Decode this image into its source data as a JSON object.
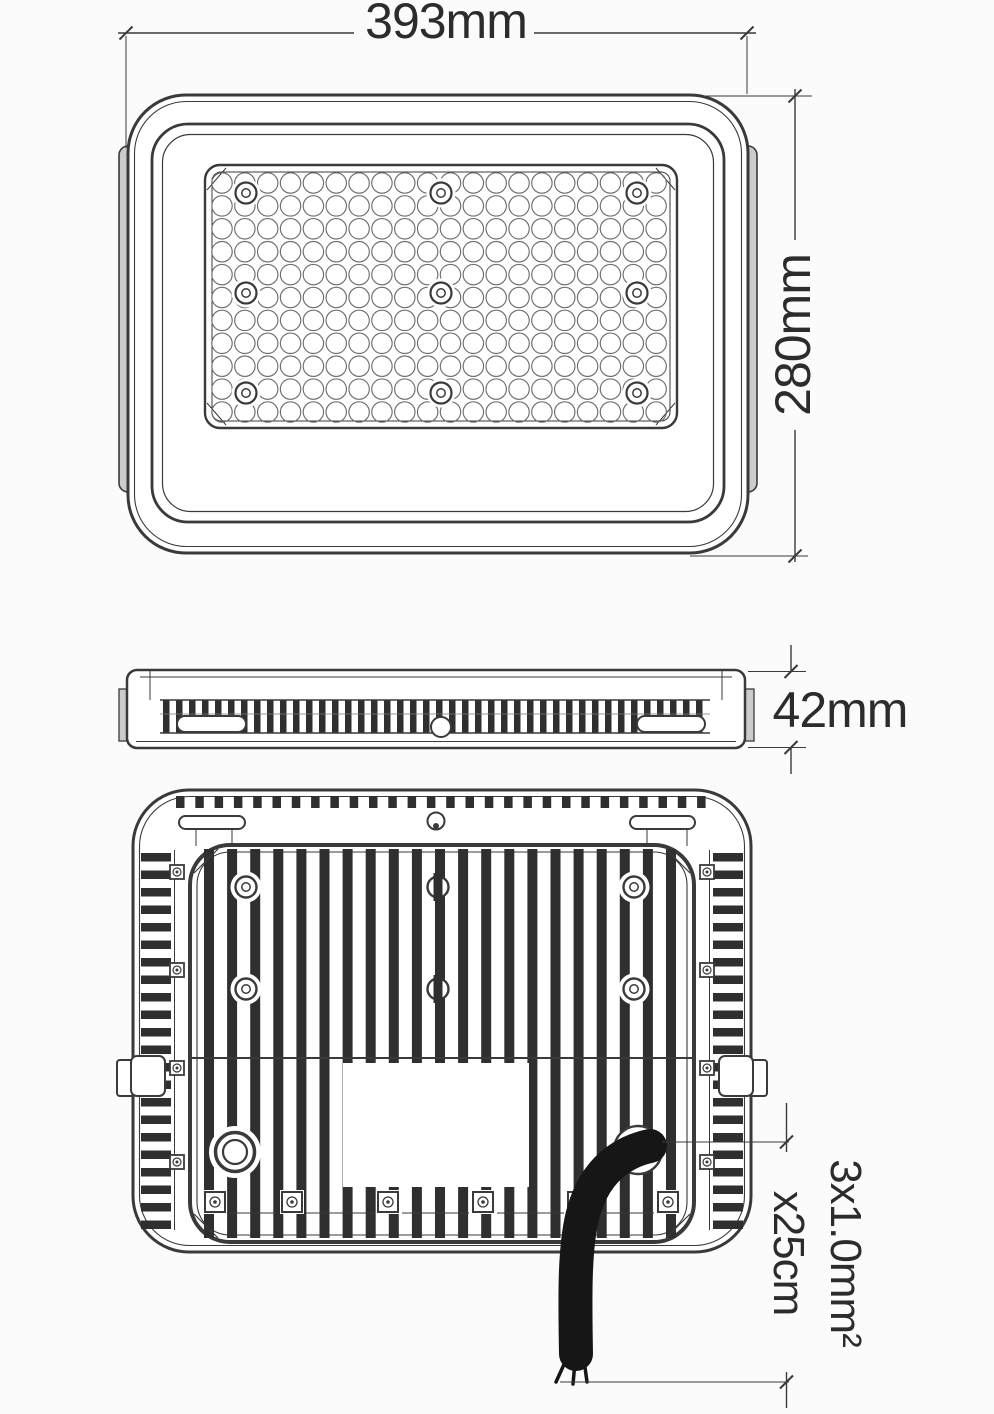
{
  "drawing": {
    "subject": "LED floodlight dimensional technical drawing, three orthographic views",
    "views": [
      "front-view",
      "side-profile-view",
      "back-heatsink-view"
    ],
    "dimensions": {
      "width_label": "393mm",
      "height_label": "280mm",
      "depth_label": "42mm",
      "cable_line1": "3x1.0mm²",
      "cable_line2": "x25cm"
    },
    "colors": {
      "background": "#fbfbfb",
      "line": "#3a3a3a",
      "fin": "#2f2f2f",
      "cable": "#161616",
      "bracket_fill": "#cccccc",
      "text": "#2c2c2c"
    }
  }
}
